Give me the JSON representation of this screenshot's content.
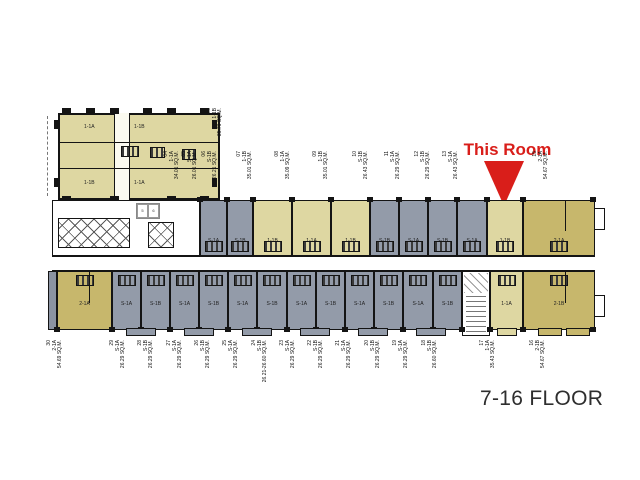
{
  "annotation": {
    "this_room": "This Room",
    "floor": "7-16 FLOOR"
  },
  "colors": {
    "tan": "#ded7a2",
    "khaki": "#c7b76c",
    "gray": "#939ba9",
    "red": "#d91e1a",
    "wall": "#141414"
  },
  "block_a": {
    "units": [
      {
        "type": "1-1A"
      },
      {
        "type": "1-1B"
      },
      {
        "type": "1-1B"
      },
      {
        "type": "1-1A"
      }
    ]
  },
  "legend": {
    "cells": [
      "5",
      "6"
    ]
  },
  "upper_units": [
    {
      "type": "S-1A"
    },
    {
      "type": "S-1B"
    },
    {
      "type": "1-1B"
    },
    {
      "type": "1-1A"
    },
    {
      "type": "1-1B"
    },
    {
      "type": "S-1B"
    },
    {
      "type": "S-1A"
    },
    {
      "type": "S-1B"
    },
    {
      "type": "S-1A"
    },
    {
      "type": "1-1B",
      "highlight": true
    },
    {
      "type": "2-1A"
    }
  ],
  "lower_units": [
    {
      "type": "2-1A"
    },
    {
      "type": "S-1A"
    },
    {
      "type": "S-1B"
    },
    {
      "type": "S-1A"
    },
    {
      "type": "S-1B"
    },
    {
      "type": "S-1A"
    },
    {
      "type": "S-1B"
    },
    {
      "type": "S-1A"
    },
    {
      "type": "S-1B"
    },
    {
      "type": "S-1A"
    },
    {
      "type": "S-1B"
    },
    {
      "type": "S-1A"
    },
    {
      "type": "S-1B"
    },
    {
      "type": "1-1A"
    },
    {
      "type": "2-1B"
    }
  ],
  "top_labels": [
    {
      "num": "03",
      "type": "1-1B",
      "area": "35.76 SQ.M."
    },
    {
      "num": "04",
      "type": "1-1A",
      "area": "34.01 SQ.M."
    },
    {
      "num": "05",
      "type": "S-1A",
      "area": "26.01 SQ.M."
    },
    {
      "num": "06",
      "type": "S-1B",
      "area": "26.21 SQ.M."
    },
    {
      "num": "07",
      "type": "1-1B",
      "area": "35.01 SQ.M."
    },
    {
      "num": "08",
      "type": "1-1A",
      "area": "35.09 SQ.M."
    },
    {
      "num": "09",
      "type": "1-1B",
      "area": "35.01 SQ.M."
    },
    {
      "num": "10",
      "type": "S-1B",
      "area": "26.43 SQ.M."
    },
    {
      "num": "11",
      "type": "S-1A",
      "area": "26.29 SQ.M."
    },
    {
      "num": "12",
      "type": "S-1B",
      "area": "26.29 SQ.M."
    },
    {
      "num": "13",
      "type": "S-1A",
      "area": "26.43 SQ.M."
    },
    {
      "num": "15",
      "type": "2-1A",
      "area": "54.67 SQ.M."
    }
  ],
  "bottom_labels": [
    {
      "num": "30",
      "type": "2-1A",
      "area": "54.69 SQ.M."
    },
    {
      "num": "29",
      "type": "S-1A",
      "area": "26.29 SQ.M."
    },
    {
      "num": "28",
      "type": "S-1B",
      "area": "26.29 SQ.M."
    },
    {
      "num": "27",
      "type": "S-1A",
      "area": "26.29 SQ.M."
    },
    {
      "num": "26",
      "type": "S-1B",
      "area": "26.29 SQ.M."
    },
    {
      "num": "25",
      "type": "S-1A",
      "area": "26.29 SQ.M."
    },
    {
      "num": "24",
      "type": "S-1B",
      "area": "26.21-26.60 SQ.M."
    },
    {
      "num": "23",
      "type": "S-1A",
      "area": "26.29 SQ.M."
    },
    {
      "num": "22",
      "type": "S-1B",
      "area": "26.29 SQ.M."
    },
    {
      "num": "21",
      "type": "S-1A",
      "area": "26.29 SQ.M."
    },
    {
      "num": "20",
      "type": "S-1B",
      "area": "26.29 SQ.M."
    },
    {
      "num": "19",
      "type": "S-1A",
      "area": "26.29 SQ.M."
    },
    {
      "num": "18",
      "type": "S-1B",
      "area": "26.60 SQ.M."
    },
    {
      "num": "17",
      "type": "1-1A",
      "area": "35.43 SQ.M."
    },
    {
      "num": "16",
      "type": "2-1B",
      "area": "54.67 SQ.M."
    }
  ]
}
